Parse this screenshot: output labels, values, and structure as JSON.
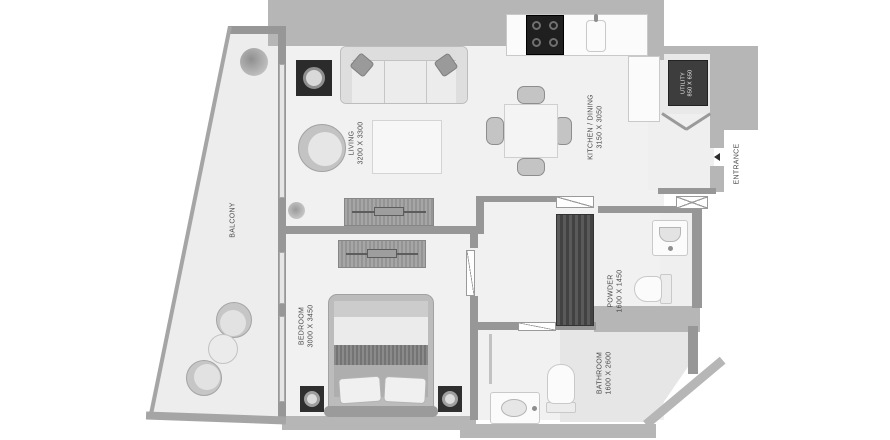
{
  "title": "apartment-floor-plan",
  "rooms": {
    "balcony": {
      "name": "BALCONY"
    },
    "living": {
      "name": "LIVING",
      "dims": "3200 X 3300"
    },
    "kitchen_dining": {
      "name": "KITCHEN / DINING",
      "dims": "3150 X 3050"
    },
    "utility": {
      "name": "UTILITY",
      "dims": "850 X 650"
    },
    "entrance": {
      "name": "ENTRANCE"
    },
    "bedroom": {
      "name": "BEDROOM",
      "dims": "3000 X 3450"
    },
    "powder": {
      "name": "POWDER",
      "dims": "1600 X 1450"
    },
    "bathroom": {
      "name": "BATHROOM",
      "dims": "1600 X 2600"
    }
  },
  "icons": [
    "sofa-icon",
    "armchair-icon",
    "coffee-table-icon",
    "side-table-lamp-icon",
    "dining-table-icon",
    "dining-chair-icon",
    "stove-icon",
    "kitchen-sink-icon",
    "kitchen-counter-icon",
    "utility-unit-icon",
    "bifold-door-icon",
    "wardrobe-icon",
    "closet-icon",
    "double-bed-icon",
    "nightstand-lamp-icon",
    "toilet-icon",
    "washbasin-icon",
    "shower-screen-icon",
    "balcony-chair-icon",
    "balcony-table-icon",
    "plant-icon",
    "entrance-arrow-icon",
    "door-leaf-icon"
  ],
  "colors": {
    "wall": "#979797",
    "outer_mask": "#b6b6b6",
    "floor": "#f1f1f1",
    "dark_fixture": "#3d3d3d",
    "label_text": "#4a4a4a"
  }
}
